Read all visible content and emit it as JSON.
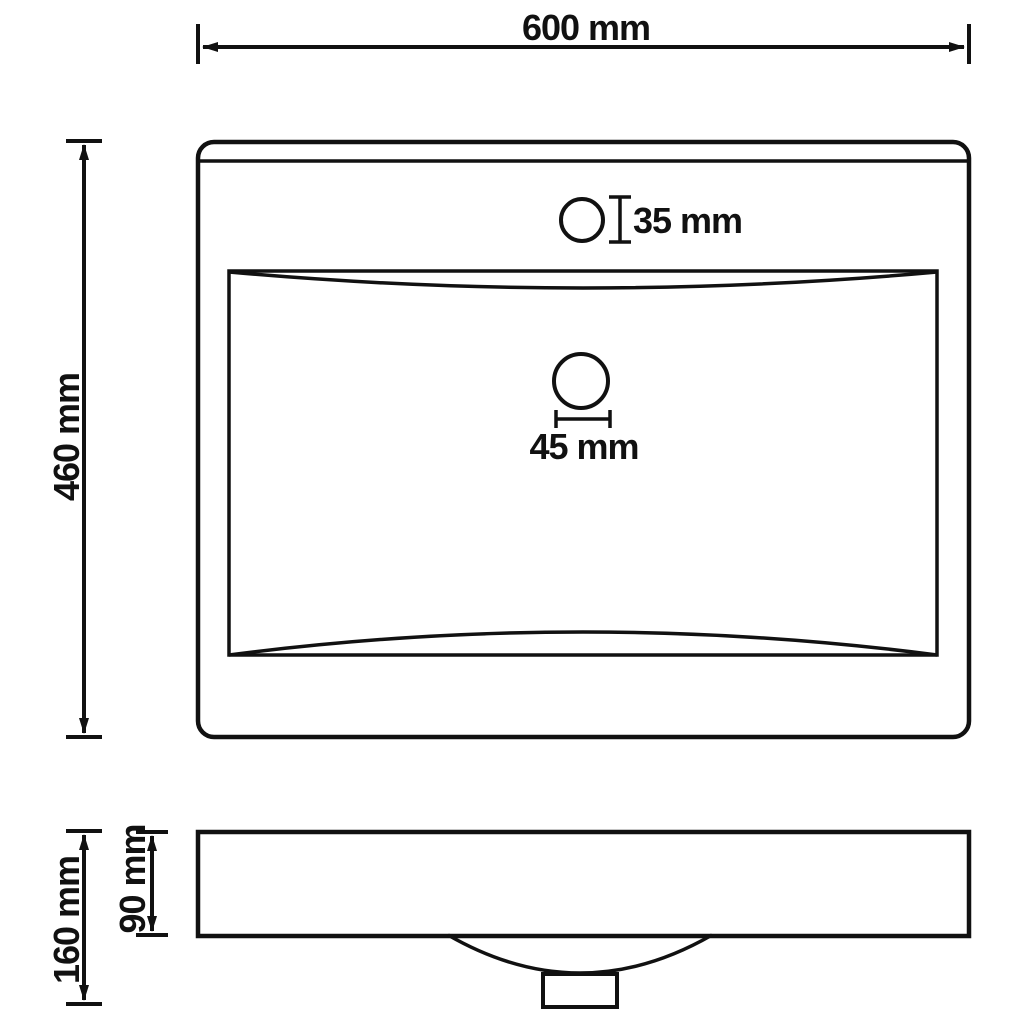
{
  "diagram": {
    "type": "technical-dimension-drawing",
    "subject": "rectangular wash basin with faucet hole, top view and side view",
    "colors": {
      "line": "#111111",
      "background": "#ffffff"
    },
    "labels": {
      "overall_width": "600 mm",
      "overall_depth": "460 mm",
      "faucet_hole_diameter": "35 mm",
      "drain_hole_diameter": "45 mm",
      "overall_height": "160 mm",
      "rim_height": "90 mm"
    }
  }
}
